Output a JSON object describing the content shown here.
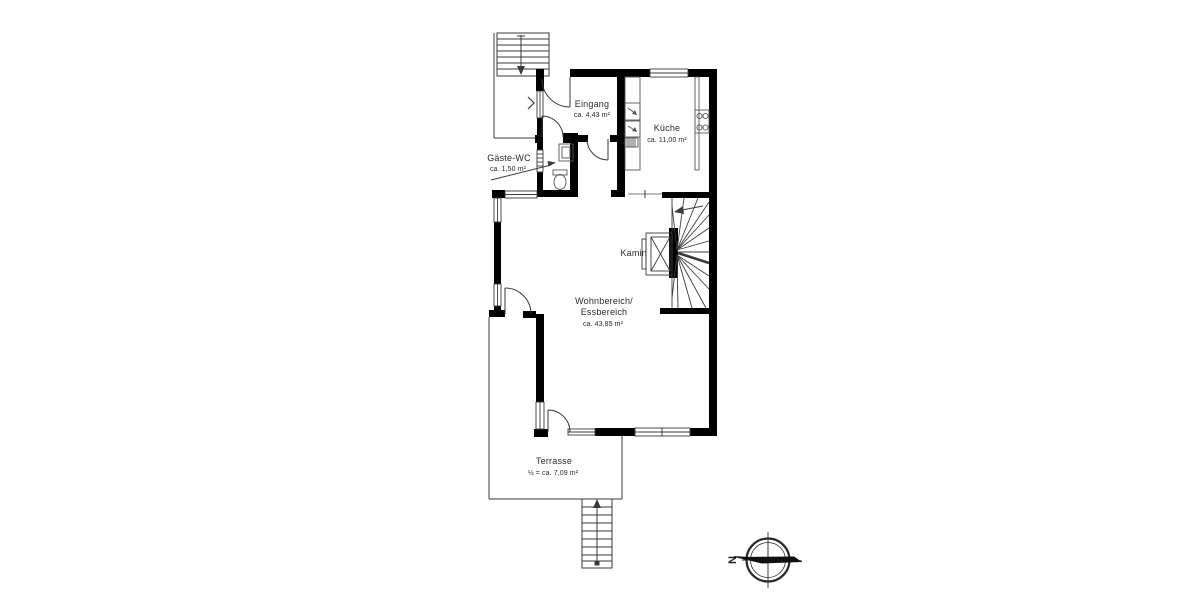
{
  "plan": {
    "title_hint": "floor plan",
    "rooms": {
      "eingang": {
        "name": "Eingang",
        "area": "ca. 4,43 m²"
      },
      "kueche": {
        "name": "Küche",
        "area": "ca. 11,00 m²"
      },
      "gaeste_wc": {
        "name": "Gäste-WC",
        "area": "ca. 1,50 m²"
      },
      "kamin": {
        "name": "Kamin"
      },
      "wohnbereich": {
        "name_line1": "Wohnbereich/",
        "name_line2": "Essbereich",
        "area": "ca. 43,85 m²"
      },
      "terrasse": {
        "name": "Terrasse",
        "area": "½ = ca. 7,09 m²"
      }
    },
    "compass": {
      "north_label": "N"
    },
    "colors": {
      "wall": "#000000",
      "thin_line": "#3a3a3a",
      "text": "#2b2b2b",
      "background": "#ffffff"
    }
  }
}
